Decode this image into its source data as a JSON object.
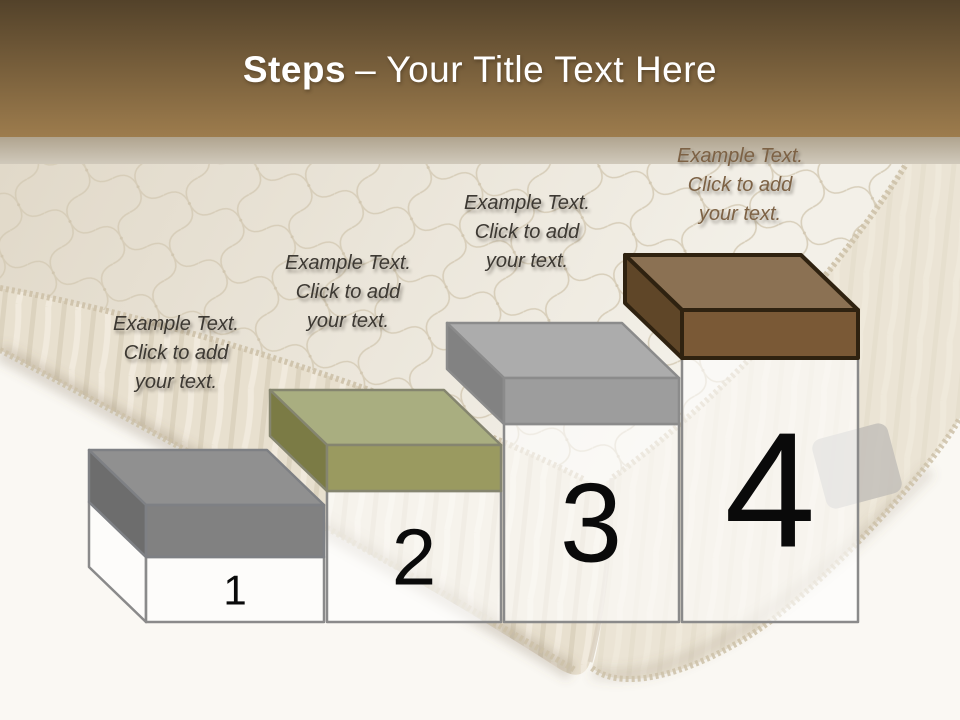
{
  "title": {
    "emphasis": "Steps",
    "rest": "– Your Title Text Here"
  },
  "steps": [
    {
      "number": "1",
      "lines": [
        "Example Text.",
        "Click  to add",
        "your text."
      ],
      "colors": {
        "top": "#909090",
        "side": "#6d6d6d",
        "front": "#818181",
        "outline": "#7e8084"
      }
    },
    {
      "number": "2",
      "lines": [
        "Example Text.",
        "Click  to add",
        "your text."
      ],
      "colors": {
        "top": "#a9ae80",
        "side": "#7b7b45",
        "front": "#9a9a60",
        "outline": "#85856f"
      }
    },
    {
      "number": "3",
      "lines": [
        "Example Text.",
        "Click  to add",
        "your text."
      ],
      "colors": {
        "top": "#acacac",
        "side": "#828282",
        "front": "#9d9d9d",
        "outline": "#8b8b8b"
      }
    },
    {
      "number": "4",
      "lines": [
        "Example Text.",
        "Click  to add",
        "your text."
      ],
      "colors": {
        "top": "#8b7153",
        "side": "#5f4628",
        "front": "#7a5936",
        "outline": "#2f2210"
      }
    }
  ],
  "palette": {
    "header_gradient_top": "#53422a",
    "header_gradient_bottom": "#9d7c4d",
    "title_color": "#ffffff",
    "divider_strip_top": "#b0a48f",
    "divider_strip_bottom": "#d0c9bb",
    "floor": "#faf8f3",
    "mattress_top_shade": "#e1d9c9",
    "mattress_top_light": "#f3f0e8",
    "mattress_side": "#e8e0cf",
    "mattress_side_right": "#eee8da",
    "quilt_line": "#d5cbb6",
    "piping": "#cdc1a8",
    "handle": "#c3c0ba",
    "box_fill": "rgba(255,255,255,0.6)",
    "box_outline": "#8a8a8a",
    "number_color": "#0a0a0a",
    "text_dark": "#3d3933",
    "text_brown": "#7d6245"
  }
}
